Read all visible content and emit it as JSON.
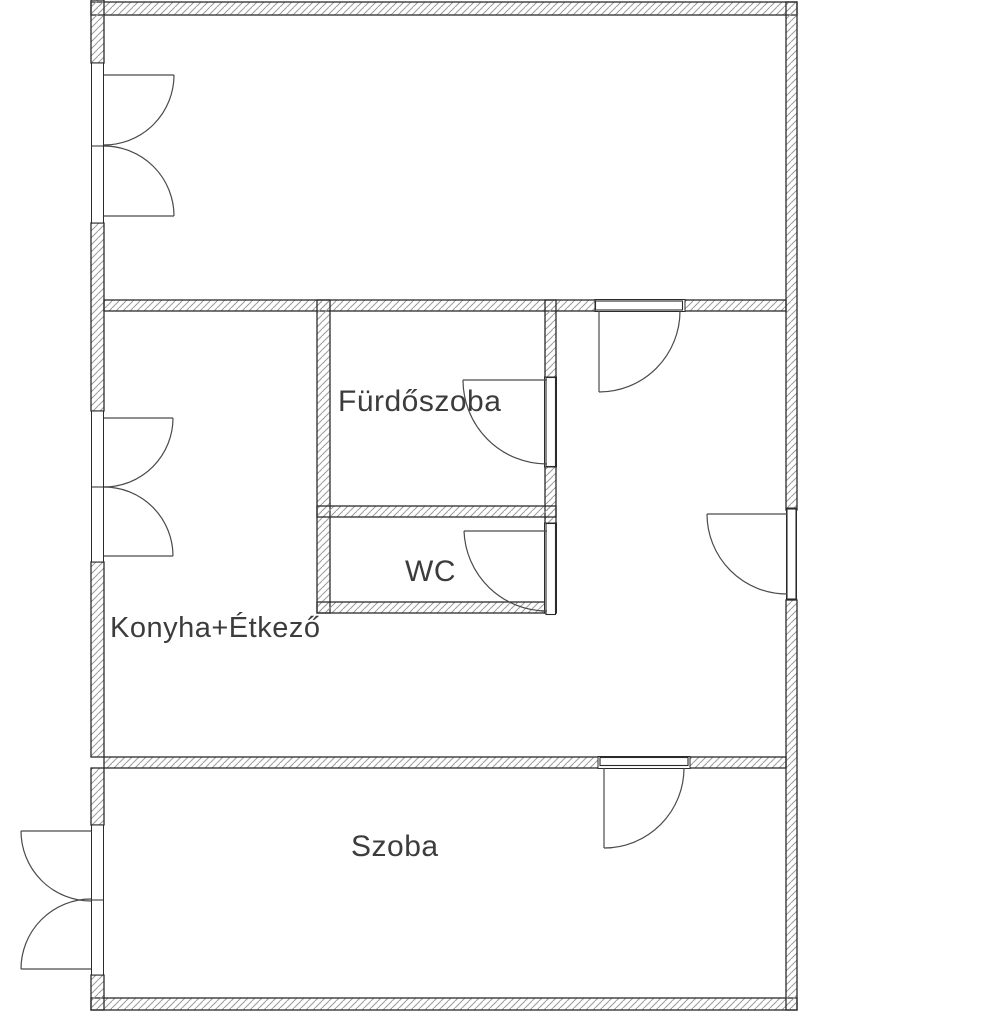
{
  "title": "Floor plan",
  "colors": {
    "wall_outline": "#2b2b2b",
    "hatch": "#9b9b9b",
    "door_line": "#4a4a4a",
    "label": "#3c3c3c",
    "background": "#ffffff"
  },
  "floor_plan": {
    "rooms": [
      {
        "id": "furdoszoba",
        "label": "Fürdőszoba"
      },
      {
        "id": "wc",
        "label": "WC"
      },
      {
        "id": "konyha_etkezo",
        "label": "Konyha+Étkező"
      },
      {
        "id": "szoba",
        "label": "Szoba"
      }
    ]
  }
}
